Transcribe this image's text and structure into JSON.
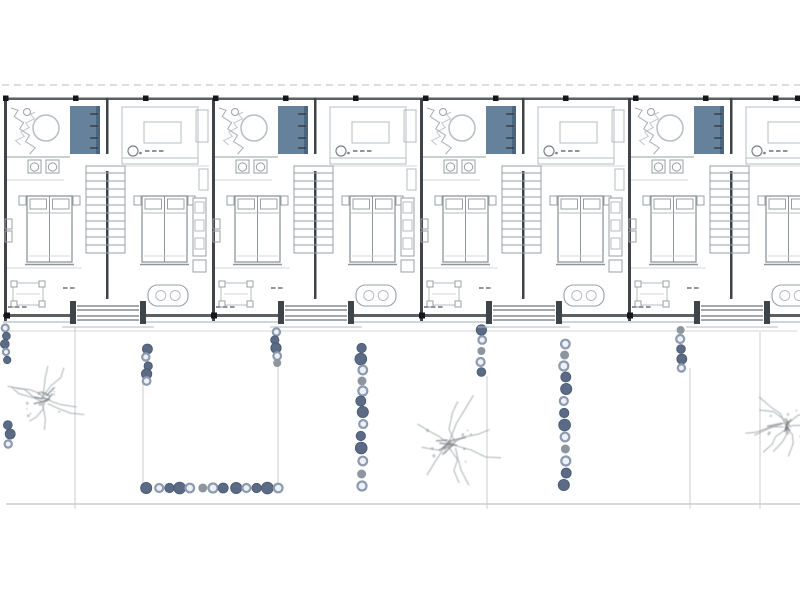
{
  "canvas": {
    "width": 800,
    "height": 600,
    "background": "#ffffff"
  },
  "colors": {
    "wallDark": "#3f444a",
    "wallMid": "#5a5f64",
    "lineLight": "#b7bcc1",
    "lineMed": "#9aa0a6",
    "lineFaint": "#d4d7da",
    "blueFill": "#66819b",
    "blueDark": "#4a657f",
    "stoneRingFill": "#edf0f4",
    "stoneRing": "#8d9ab0",
    "stoneDark": "#5b6b85",
    "stoneDarkEdge": "#495870",
    "stoneGray": "#8e959f",
    "treeStroke": "#9aa0a4",
    "treeDark": "#777c80",
    "marker": "#141619",
    "gardenLine": "#c9cdd0",
    "dashLine": "#cfd3d6"
  },
  "plan": {
    "dashed_line_y": 85,
    "top_wall_y": 97.5,
    "top_wall_h": 2.5,
    "bottom_wall_y": 314,
    "bottom_wall_h": 3,
    "bottom_edge_line_y": 322,
    "left_x": 3,
    "right_x": 800,
    "unit_width": 208,
    "unit_count": 4,
    "unit_origins": [
      4,
      212,
      420,
      628
    ],
    "top_markers": {
      "y": 95.5,
      "size": 5.5,
      "xs": [
        3,
        73,
        143,
        213,
        283,
        353,
        423,
        493,
        563,
        633,
        703,
        773,
        795
      ]
    },
    "bottom_markers": {
      "y": 312.5,
      "size": 6,
      "xs": [
        4,
        211,
        419,
        627
      ]
    },
    "unit_elements": [
      {
        "kind": "wallv",
        "name": "party-wall",
        "x": 0,
        "w": 3,
        "y1": 98,
        "y2": 321
      },
      {
        "kind": "wallv",
        "name": "mid-wall-upper",
        "x": 102,
        "w": 2.5,
        "y1": 98,
        "y2": 154
      },
      {
        "kind": "wallv",
        "name": "mid-wall-lower",
        "x": 102,
        "w": 2.5,
        "y1": 171,
        "y2": 307
      },
      {
        "kind": "scribble",
        "name": "vanity-sketch",
        "x": 7,
        "y": 104,
        "w": 24,
        "h": 50,
        "seed": 3
      },
      {
        "kind": "circle",
        "name": "bathtub",
        "cx": 42,
        "cy": 128,
        "r": 13
      },
      {
        "kind": "line",
        "name": "bath-partition",
        "x1": 3,
        "y1": 157,
        "x2": 66,
        "y2": 157,
        "c": "lineMed"
      },
      {
        "kind": "line",
        "name": "bath-partition-lower",
        "x1": 3,
        "y1": 180,
        "x2": 60,
        "y2": 180,
        "c": "lineFaint"
      },
      {
        "kind": "rect",
        "name": "wardrobe-blue",
        "x": 66,
        "y": 106,
        "w": 27,
        "h": 48,
        "fill": "blueFill"
      },
      {
        "kind": "rect",
        "name": "wardrobe-side",
        "x": 92,
        "y": 106,
        "w": 4,
        "h": 48,
        "fill": "blueDark"
      },
      {
        "kind": "ticksv",
        "name": "wardrobe-shelf-ticks",
        "x": 86,
        "len": 8,
        "ys": [
          114,
          126,
          138,
          148
        ]
      },
      {
        "kind": "basin",
        "name": "basin",
        "x": 24,
        "y": 160,
        "s": 13
      },
      {
        "kind": "basin",
        "name": "basin",
        "x": 42,
        "y": 160,
        "s": 13
      },
      {
        "kind": "rect",
        "name": "nightstand",
        "x": 15,
        "y": 196,
        "w": 7,
        "h": 9,
        "stroke": "lineMed"
      },
      {
        "kind": "rect",
        "name": "nightstand",
        "x": 69,
        "y": 196,
        "w": 7,
        "h": 9,
        "stroke": "lineMed"
      },
      {
        "kind": "bed",
        "name": "bed-left",
        "x": 23,
        "y": 196,
        "w": 45,
        "h": 66
      },
      {
        "kind": "rect",
        "name": "wall-shelf",
        "x": 1,
        "y": 219,
        "w": 7,
        "h": 10,
        "stroke": "lineMed"
      },
      {
        "kind": "rect",
        "name": "wall-shelf",
        "x": 1,
        "y": 231,
        "w": 7,
        "h": 11,
        "stroke": "lineMed"
      },
      {
        "kind": "line",
        "name": "bedroom-line",
        "x1": 3,
        "y1": 268,
        "x2": 78,
        "y2": 268,
        "c": "lineFaint"
      },
      {
        "kind": "desk",
        "name": "desk",
        "x": 9,
        "y": 283,
        "w": 30,
        "h": 22
      },
      {
        "kind": "marks",
        "name": "note-marks",
        "x": 4,
        "y": 307,
        "n": 3
      },
      {
        "kind": "marks",
        "name": "note-marks",
        "x": 59,
        "y": 288,
        "n": 2
      },
      {
        "kind": "rect",
        "name": "living-rug",
        "x": 118,
        "y": 107,
        "w": 76,
        "h": 57,
        "stroke": "lineLight"
      },
      {
        "kind": "rect",
        "name": "living-table",
        "x": 140,
        "y": 122,
        "w": 37,
        "h": 21,
        "stroke": "lineLight"
      },
      {
        "kind": "line",
        "name": "sofa-line",
        "x1": 118,
        "y1": 158,
        "x2": 194,
        "y2": 158,
        "c": "lineLight"
      },
      {
        "kind": "lamp",
        "name": "lamp-icon",
        "cx": 129,
        "cy": 151,
        "r": 5
      },
      {
        "kind": "marks",
        "name": "sofa-marks",
        "x": 141,
        "y": 151,
        "n": 3
      },
      {
        "kind": "rect",
        "name": "sideboard",
        "x": 192,
        "y": 110,
        "w": 12,
        "h": 32,
        "stroke": "lineLight"
      },
      {
        "kind": "line",
        "name": "living-floor-line",
        "x1": 104,
        "y1": 166,
        "x2": 205,
        "y2": 166,
        "c": "lineFaint"
      },
      {
        "kind": "stairs",
        "name": "staircase",
        "x": 82,
        "y": 173,
        "w": 39,
        "h": 80,
        "steps": 10
      },
      {
        "kind": "rect",
        "name": "nightstand",
        "x": 130,
        "y": 196,
        "w": 7,
        "h": 9,
        "stroke": "lineMed"
      },
      {
        "kind": "rect",
        "name": "nightstand",
        "x": 184,
        "y": 196,
        "w": 7,
        "h": 9,
        "stroke": "lineMed"
      },
      {
        "kind": "bed",
        "name": "bed-right",
        "x": 138,
        "y": 196,
        "w": 45,
        "h": 66
      },
      {
        "kind": "rect",
        "name": "fridge",
        "x": 195,
        "y": 169,
        "w": 9,
        "h": 21,
        "stroke": "lineLight"
      },
      {
        "kind": "kitchen",
        "name": "kitchen-counter",
        "x": 189,
        "y": 198,
        "w": 13,
        "h": 58
      },
      {
        "kind": "rect",
        "name": "kitchen-lower",
        "x": 189,
        "y": 260,
        "w": 13,
        "h": 12,
        "stroke": "lineMed"
      },
      {
        "kind": "ovaltable",
        "name": "dining-table",
        "x": 144,
        "y": 285,
        "w": 40,
        "h": 21
      },
      {
        "kind": "porch",
        "name": "entry-porch",
        "x": 66,
        "y": 301,
        "w": 76,
        "h": 23
      }
    ]
  },
  "garden": {
    "top_faint_line_y": 331,
    "bottom_line_y": 504,
    "dividers": [
      {
        "x": 75,
        "y1": 326,
        "y2": 509
      },
      {
        "x": 143,
        "y1": 378,
        "y2": 492
      },
      {
        "x": 278,
        "y1": 356,
        "y2": 492
      },
      {
        "x": 487,
        "y1": 376,
        "y2": 509
      },
      {
        "x": 690,
        "y1": 368,
        "y2": 509
      },
      {
        "x": 760,
        "y1": 332,
        "y2": 509
      }
    ],
    "stone_columns": [
      {
        "x": 6,
        "r": 3.5,
        "ys": [
          328,
          336,
          344,
          352,
          360
        ]
      },
      {
        "x": 9,
        "r": 4,
        "ys": [
          425,
          434,
          444
        ]
      },
      {
        "x": 147,
        "r": 4,
        "ys": [
          349,
          357,
          366,
          374,
          381
        ]
      },
      {
        "x": 276,
        "r": 4,
        "ys": [
          332,
          340,
          348,
          356,
          363
        ]
      },
      {
        "x": 362,
        "r": 4.5,
        "ys": [
          348,
          359,
          370,
          381,
          391,
          401,
          412,
          424,
          436,
          448,
          461,
          474,
          486
        ]
      },
      {
        "x": 481,
        "r": 4,
        "ys": [
          330,
          340,
          351,
          362,
          372
        ]
      },
      {
        "x": 565,
        "r": 4.5,
        "ys": [
          344,
          355,
          366,
          377,
          389,
          401,
          413,
          425,
          437,
          449,
          461,
          473,
          485
        ]
      },
      {
        "x": 681,
        "r": 4,
        "ys": [
          330,
          339,
          349,
          359,
          368
        ]
      }
    ],
    "stone_row": {
      "y": 488,
      "r": 4.5,
      "xs": [
        147,
        158,
        169,
        180,
        191,
        202,
        213,
        224,
        235,
        246,
        257,
        267,
        277
      ]
    },
    "stone_styles": [
      "ring",
      "dark",
      "dark",
      "ring",
      "dark",
      "dark",
      "ring",
      "gray"
    ],
    "trees": [
      {
        "cx": 45,
        "cy": 400,
        "scale": 1.0,
        "seed": 11
      },
      {
        "cx": 452,
        "cy": 444,
        "scale": 1.25,
        "seed": 23
      },
      {
        "cx": 787,
        "cy": 424,
        "scale": 1.0,
        "seed": 37
      }
    ]
  }
}
